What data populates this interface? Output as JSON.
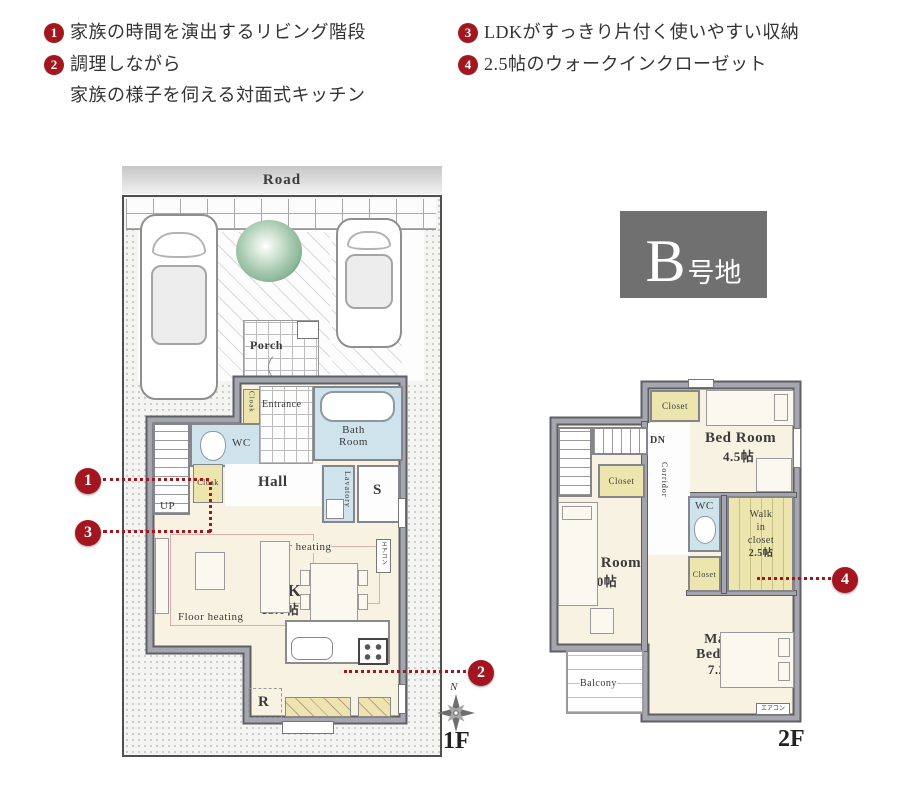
{
  "features": {
    "items": [
      {
        "num": "1",
        "line1": "家族の時間を演出するリビング階段"
      },
      {
        "num": "2",
        "line1": "調理しながら",
        "line2": "家族の様子を伺える対面式キッチン"
      },
      {
        "num": "3",
        "line1": "LDKがすっきり片付く使いやすい収納"
      },
      {
        "num": "4",
        "line1": "2.5帖のウォークインクローゼット"
      }
    ]
  },
  "lot": {
    "letter": "B",
    "suffix": "号地"
  },
  "f1": {
    "label": "1F",
    "compass_n": "N",
    "road": "Road",
    "porch": "Porch",
    "entrance": "Entrance",
    "wc": "WC",
    "bath_l1": "Bath",
    "bath_l2": "Room",
    "hall": "Hall",
    "cloak_a": "Cloak",
    "cloak_b": "Cloak",
    "lavatory": "Lavatory",
    "storage": "S",
    "up": "UP",
    "ldk": "LDK",
    "ldk_size": "15.0帖",
    "floor_heating_a": "Floor heating",
    "floor_heating_b": "Floor heating",
    "fridge": "R",
    "aircon": "エアコン"
  },
  "f2": {
    "label": "2F",
    "dn": "DN",
    "corridor": "Corridor",
    "closet_top": "Closet",
    "closet_mid": "Closet",
    "closet_small": "Closet",
    "bed1": "Bed Room",
    "bed1_size": "4.5帖",
    "bed2": "Bed Room",
    "bed2_size": "5.0帖",
    "wc": "WC",
    "wic_l1": "Walk",
    "wic_l2": "in",
    "wic_l3": "closet",
    "wic_size": "2.5帖",
    "master_l1": "Master",
    "master_l2": "Bed Room",
    "master_size": "7.25帖",
    "balcony": "Balcony",
    "aircon": "エアコン"
  },
  "markers": {
    "m1": "1",
    "m2": "2",
    "m3": "3",
    "m4": "4"
  },
  "colors": {
    "accent_red": "#a3161f",
    "lot_bg": "#707070",
    "wall_gray": "#a4a4ac",
    "wet_blue": "#cfe3ec",
    "closet_yellow": "#ece6ae",
    "floor_cream": "#f7f2e2"
  }
}
